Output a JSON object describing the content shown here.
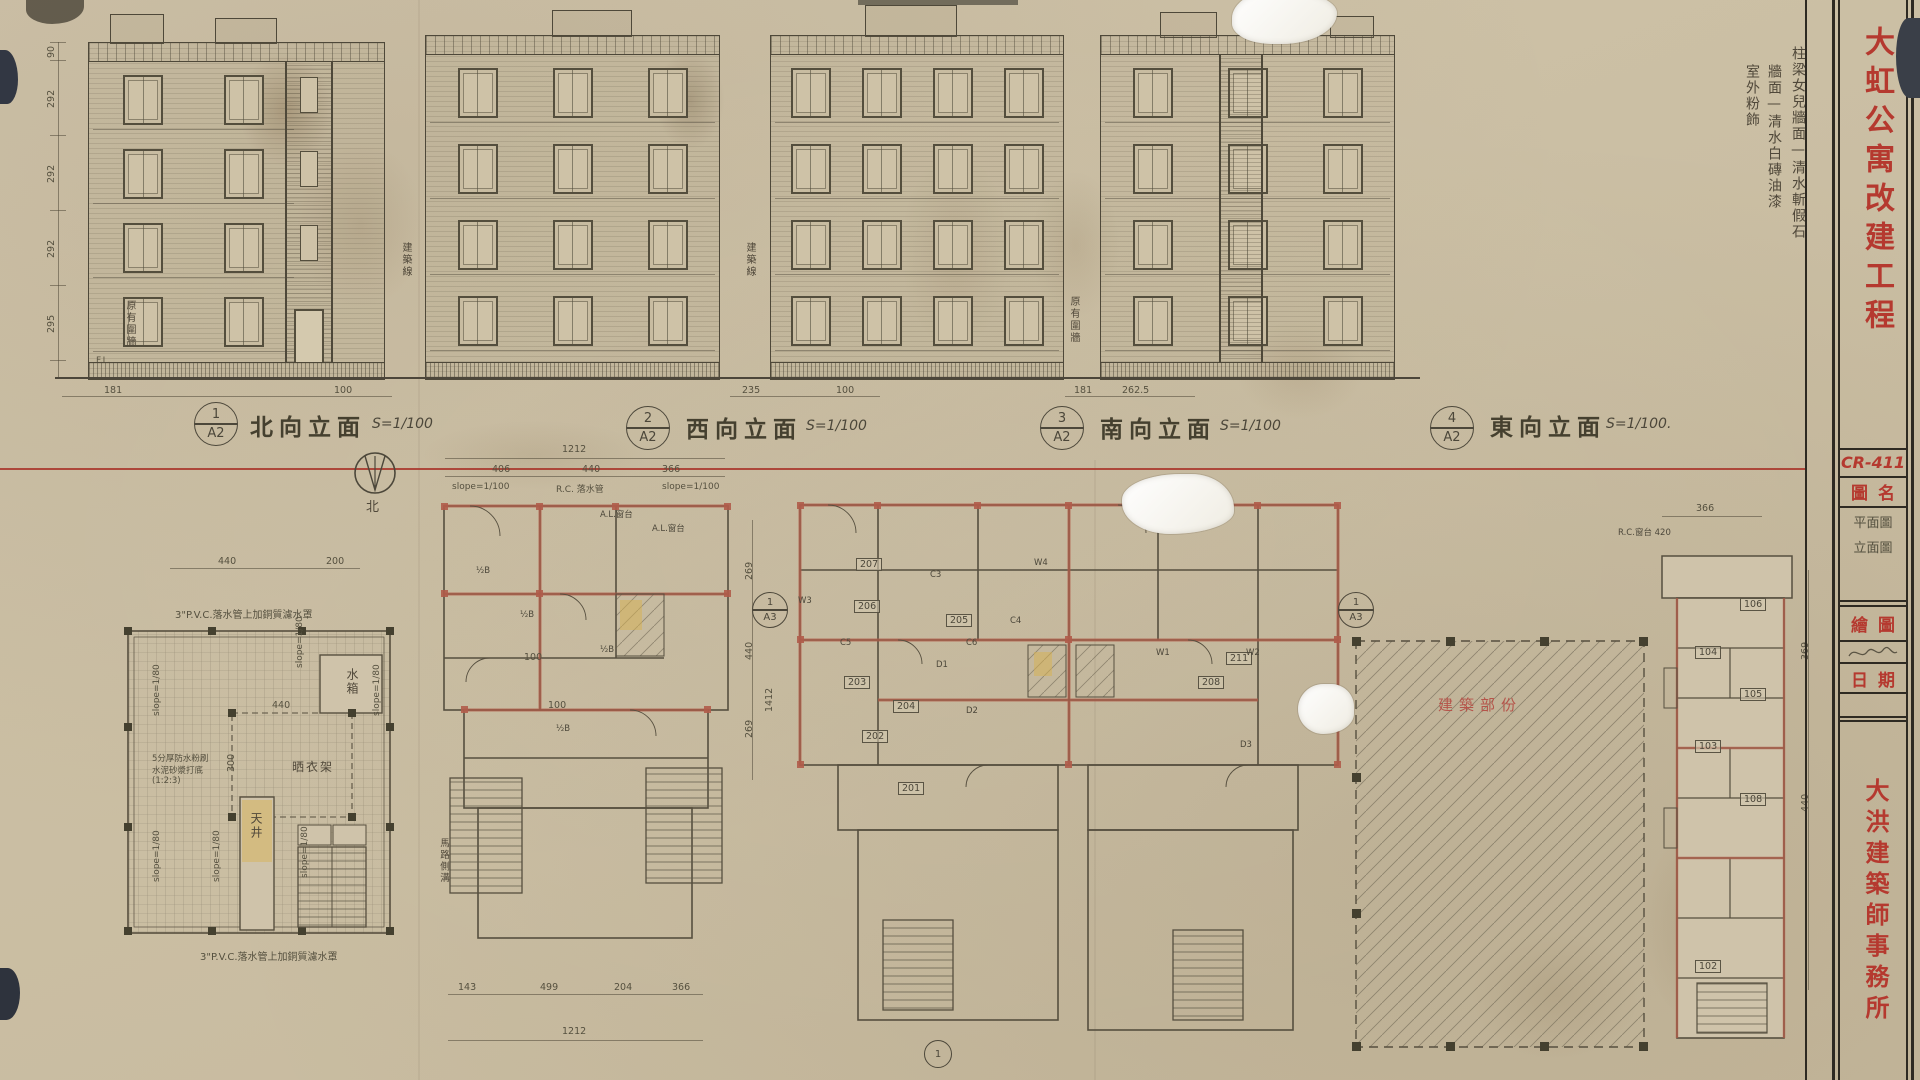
{
  "sheet": {
    "project_title": "大虹公寓改建工程",
    "sheet_no": "CR-411",
    "firm": "大洪建築師事務所",
    "titleblock": {
      "drawing_name_label": "圖名",
      "drawing_names": [
        "平面圖",
        "立面圖"
      ],
      "drawn_by_label": "繪圖",
      "date_label": "日期"
    },
    "finish_notes": [
      "柱梁女兒牆面—清水斬假石",
      "牆面—清水白磚油漆",
      "室外粉飾"
    ],
    "accent_red": "#b5392f",
    "pencil": "#4f4a3b"
  },
  "elevations": {
    "items": [
      {
        "no": "1",
        "sheet": "A2",
        "name": "北向立面",
        "scale": "S=1/100"
      },
      {
        "no": "2",
        "sheet": "A2",
        "name": "西向立面",
        "scale": "S=1/100"
      },
      {
        "no": "3",
        "sheet": "A2",
        "name": "南向立面",
        "scale": "S=1/100"
      },
      {
        "no": "4",
        "sheet": "A2",
        "name": "東向立面",
        "scale": "S=1/100."
      }
    ],
    "left_dims": [
      "90",
      "292",
      "292",
      "292",
      "295"
    ],
    "level_label_fl": "F.L.",
    "base_dims_1": [
      "181",
      "100"
    ],
    "base_dims_3": [
      "235",
      "100"
    ],
    "base_dims_4": [
      "181",
      "262.5"
    ],
    "building_line_label": "建築線",
    "existing_fence_label": "原有圍牆"
  },
  "plans": {
    "north_label": "北",
    "roof": {
      "note_top": "3\"P.V.C.落水管上加銅質濾水罩",
      "note_bottom": "3\"P.V.C.落水管上加銅質濾水罩",
      "waterproof_note": [
        "5分厚防水粉刷",
        "水泥砂漿打底",
        "(1:2:3)"
      ],
      "slope": "slope=1/80",
      "water_tank": "水箱",
      "drying_rack": "晒衣架",
      "light_well": "天井",
      "dim_top_w": "440",
      "dim_top_e": "200",
      "dim_center_w": "440",
      "dim_center_h": "300"
    },
    "typical": {
      "total_top": "1212",
      "top_dims": [
        "406",
        "440",
        "366"
      ],
      "note_left": "slope=1/100",
      "note_center": "R.C. 落水管",
      "note_right": "slope=1/100",
      "wall_mark": "½B",
      "sill": "A.L.窗台",
      "dim_100": "100",
      "right_dims": [
        "269",
        "440",
        "269"
      ],
      "total_right": "1412",
      "bottom_dims": [
        "143",
        "499",
        "204",
        "366"
      ],
      "total_bottom": "1212",
      "street": "馬路側溝"
    },
    "numbered": {
      "rooms": [
        "201",
        "202",
        "203",
        "204",
        "205",
        "206",
        "207",
        "208",
        "211"
      ],
      "tags": [
        "W1",
        "W2",
        "W3",
        "W4",
        "D1",
        "D2",
        "D3",
        "C3",
        "C4",
        "C5",
        "C6"
      ],
      "grid_ref_top": "1",
      "grid_ref_bottom": "A3",
      "detail_mark": "1"
    },
    "site": {
      "area_label": "建築部份",
      "dim_top": "366",
      "sill_note": "R.C.窗台 420",
      "right_dims": [
        "369",
        "440"
      ],
      "rooms": [
        "106",
        "104",
        "105",
        "103",
        "108",
        "102"
      ]
    }
  }
}
